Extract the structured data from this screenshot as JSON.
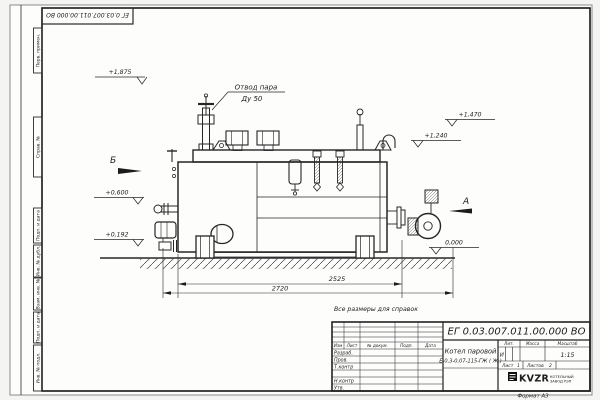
{
  "page": {
    "corner_stamp": "ЕГ 0.03.007.011.00.000  ВО",
    "reference_note": "Все размеры для справок",
    "format_note": "Формат А3"
  },
  "margin": {
    "perv_primen": "Перв. примен.",
    "sprav_no": "Справ. №",
    "podp_data_1": "Подп. и дата",
    "inv_dubl": "Инв. № дубл.",
    "vzam_inv": "Взам. инв. №",
    "podp_data_2": "Подп. и дата",
    "inv_podl": "Инв. № подл."
  },
  "drawing": {
    "callout": {
      "line1": "Отвод пара",
      "line2": "Ду 50"
    },
    "elevations": {
      "top": "+1,875",
      "right_upper": "+1,470",
      "right_mid": "+1,240",
      "left_upper": "+0,600",
      "left_lower": "+0,192",
      "ground": "0,000"
    },
    "views": {
      "b": "Б",
      "a": "А"
    },
    "dims": {
      "inner": "2525",
      "outer": "2720"
    }
  },
  "tb": {
    "doc_number": "ЕГ 0.03.007.011.00.000  ВО",
    "product_line1": "Котел паровой",
    "product_line2": "Е-0,3-0,07-115-ГЖ ( Ж )",
    "cols": {
      "izm": "Изм",
      "list": "Лист",
      "doc": "№ докум.",
      "podp": "Подп.",
      "data": "Дата"
    },
    "roles": {
      "razrab": "Разраб.",
      "prov": "Пров.",
      "tkontr": "Т.контр",
      "nkontr": "Н.контр",
      "utv": "Утв."
    },
    "lit_label": "Лит.",
    "lit_value": "И",
    "mass_label": "Масса",
    "scale_label": "Масштаб",
    "scale_value": "1:15",
    "sheet_label": "Лист",
    "sheet_value": "1",
    "sheets_label": "Листов",
    "sheets_value": "2",
    "logo": "KVZR",
    "logo_sub1": "КОТЕЛЬНЫЙ",
    "logo_sub2": "ЗАВОД РЭП"
  }
}
